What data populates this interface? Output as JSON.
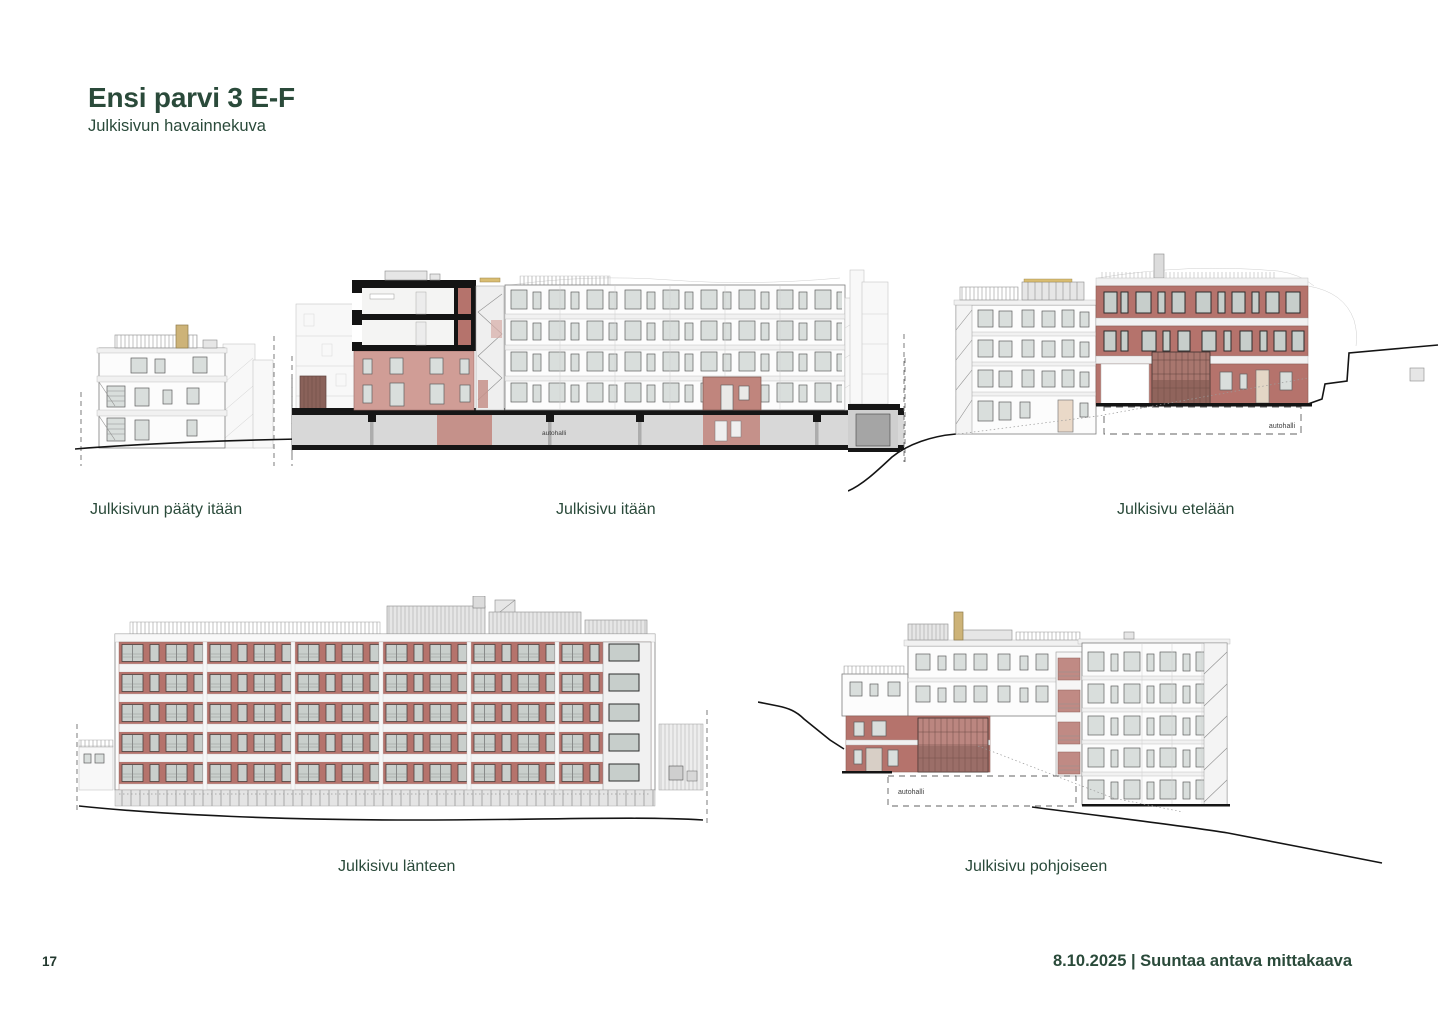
{
  "page": {
    "title": "Ensi parvi 3 E-F",
    "subtitle": "Julkisivun havainnekuva",
    "page_number": "17",
    "footer_right": "8.10.2025 | Suuntaa antava mittakaava"
  },
  "figures": {
    "east_end": {
      "caption": "Julkisivun pääty itään"
    },
    "east": {
      "caption": "Julkisivu itään",
      "label_autohalli": "autohalli"
    },
    "south": {
      "caption": "Julkisivu etelään",
      "label_autohalli": "autohalli"
    },
    "west": {
      "caption": "Julkisivu länteen"
    },
    "north": {
      "caption": "Julkisivu pohjoiseen",
      "label_autohalli": "autohalli"
    }
  },
  "colors": {
    "accent_green": "#2a4a3a",
    "brick_red": "#b5736c",
    "light_brick": "#d09d96",
    "section_black": "#141414",
    "window_glass": "#d9dedc",
    "chimney_tan": "#cdb378"
  }
}
